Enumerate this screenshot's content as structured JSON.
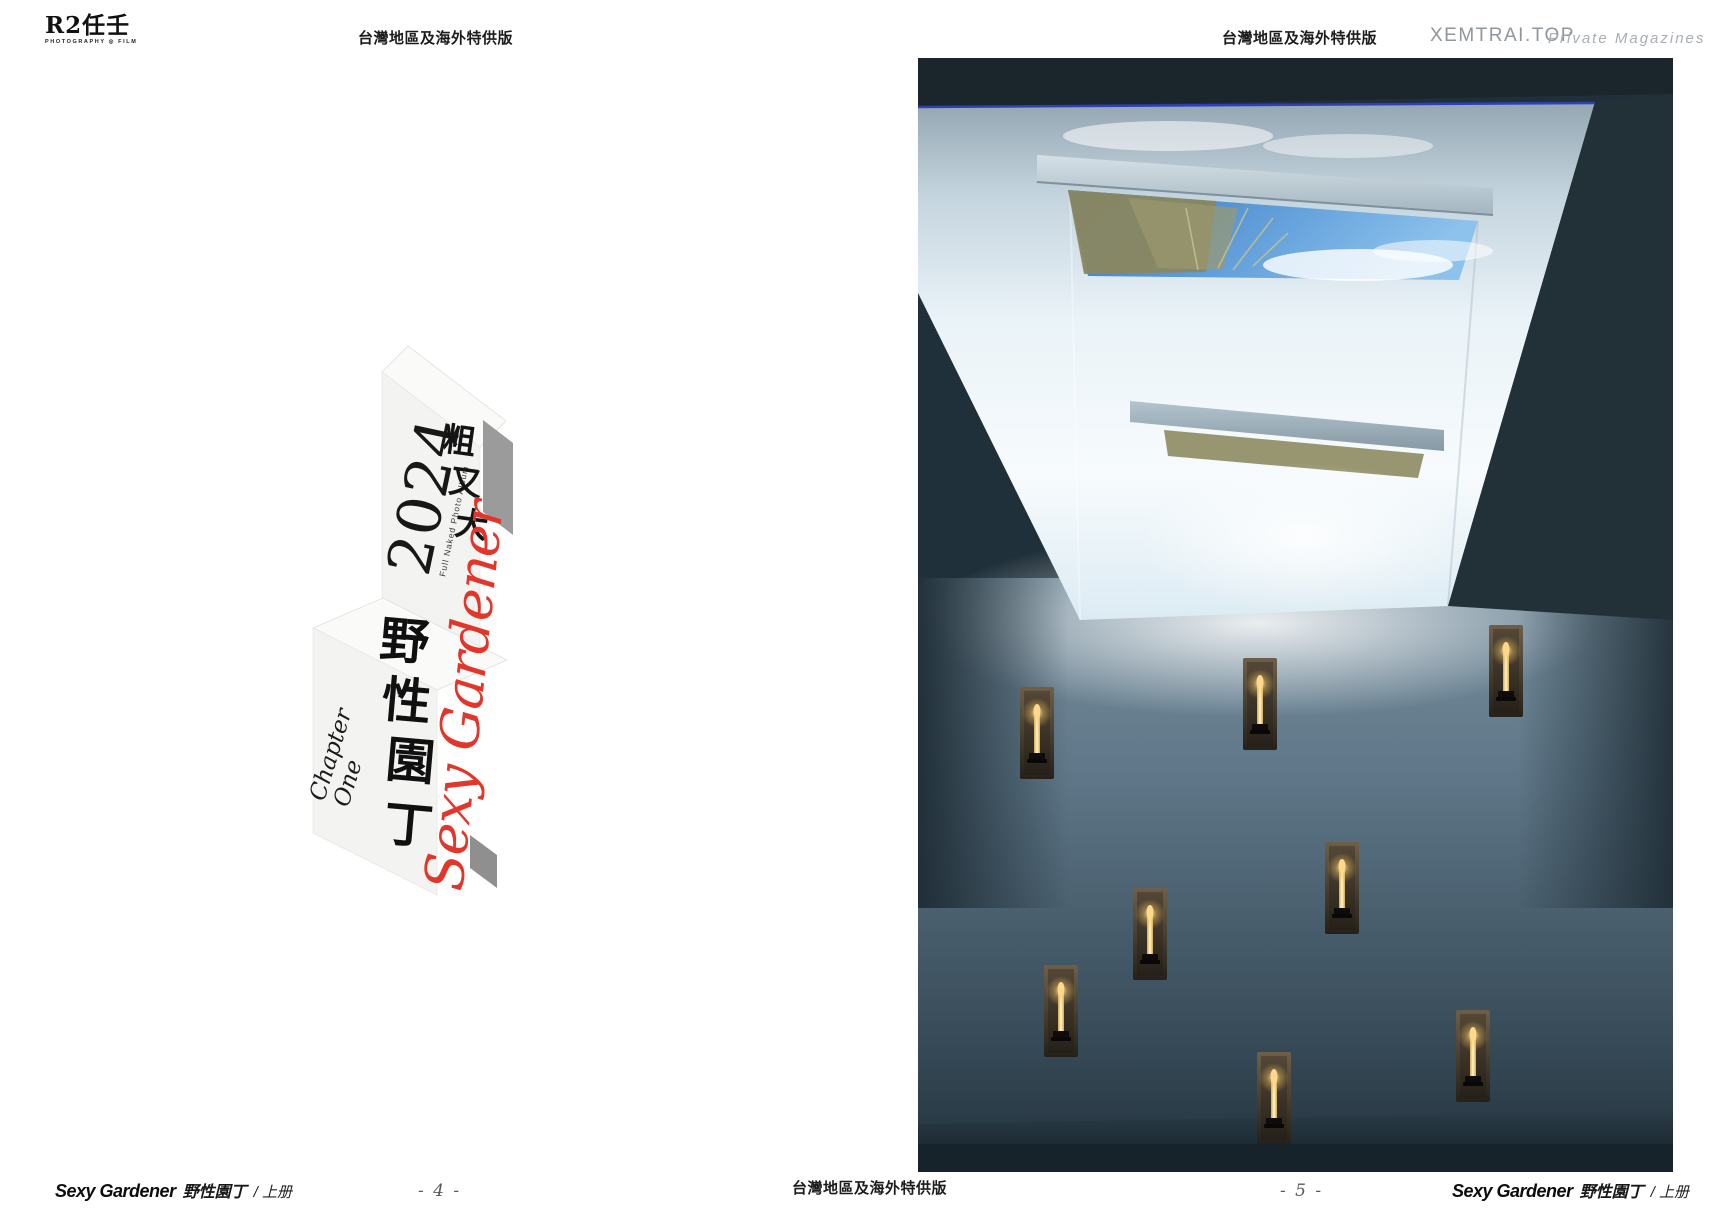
{
  "brand": {
    "logo_text": "R2任壬",
    "logo_sub": "PHOTOGRAPHY ◎ FILM"
  },
  "header": {
    "edition_left": "台灣地區及海外特供版",
    "edition_right": "台灣地區及海外特供版",
    "site": "XEMTRAI.TOP",
    "site_tagline": "Private Magazines"
  },
  "title_block": {
    "year": "2024",
    "album_subtitle": "Full Naked Photo Album",
    "tagline_chars": [
      "粗",
      "又",
      "大"
    ],
    "series_title": "Sexy Gardener",
    "main_title_chars": [
      "野",
      "性",
      "園",
      "丁"
    ],
    "chapter_word": "Chapter",
    "chapter_number": "One",
    "accent_red": "#e3362b"
  },
  "footer": {
    "book_title": "Sexy Gardener",
    "book_title_cn": "野性園丁",
    "volume": "/ 上册",
    "page_number_left": "- 4 -",
    "edition_center": "台灣地區及海外特供版",
    "page_number_right": "- 5 -"
  },
  "photo": {
    "description": "view upward into a white skylight light-well with blue sky and dune grass, above a blue-grey wall with eight recessed candle sconces",
    "colors": {
      "sky_blue": "#3f86d2",
      "wall_blue_grey": "#5d7586",
      "ceiling_dark": "#1d262c",
      "candle_flame": "#f2cf8a",
      "skylight_line_blue": "#2e3fb8"
    }
  }
}
